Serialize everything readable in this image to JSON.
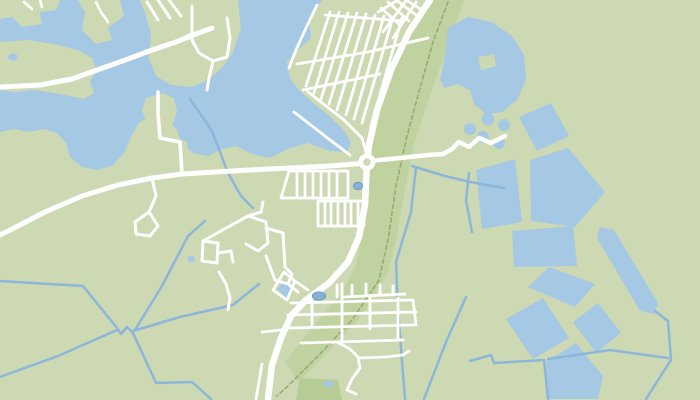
{
  "map": {
    "kind": "unlabeled-map-viewport",
    "visible_text": [],
    "colors": {
      "land": "#cdd9b2",
      "forest": "#c0d2a0",
      "forest_dark": "#b6cc95",
      "water": "#a5c8e4",
      "canal": "#8cb6da",
      "pond_dark_fill": "#8ab2d8",
      "pond_dark_stroke": "#6f9fc8",
      "road": "#ffffff",
      "trail": "#94ae72"
    },
    "layers": [
      {
        "name": "land-base",
        "kind": "polygon",
        "fill": "land",
        "d": "M0,0 L700,0 L700,400 L0,400 Z"
      },
      {
        "name": "forest-rail-strip",
        "kind": "polygon",
        "fill": "forest",
        "d": "M430,0 L464,0 L448,45 L430,95 L414,145 L404,195 L396,240 L388,272 L360,318 L322,358 L298,382 L285,362 L310,330 L340,295 L355,268 L362,235 L366,198 L369,160 L372,120 L382,83 L398,45 Z"
      },
      {
        "name": "forest-south-patch",
        "kind": "polygon",
        "fill": "forest_dark",
        "d": "M300,378 L338,380 L342,400 L296,400 Z"
      },
      {
        "name": "lake-northwest",
        "kind": "polygon",
        "fill": "water",
        "d": "M0,0 L322,0 L309,18 L311,38 L298,50 L287,62 L290,78 L299,90 L312,102 L328,115 L342,128 L351,142 L347,152 L330,151 L308,143 L287,149 L270,158 L252,154 L236,146 L222,149 L208,156 L193,153 L182,144 L177,130 L167,119 L152,115 L139,123 L131,137 L124,153 L113,165 L98,170 L82,167 L70,157 L66,143 L57,133 L44,129 L28,132 L14,129 L0,132 Z"
      },
      {
        "name": "lake-northeast",
        "kind": "polygon",
        "fill": "water",
        "d": "M448,28 L468,17 L492,22 L512,36 L524,55 L526,80 L517,100 L502,112 L486,114 L474,104 L470,90 L458,84 L444,88 L440,80 L445,55 Z"
      },
      {
        "name": "island-corner",
        "kind": "polygon",
        "fill": "land",
        "d": "M0,0 L60,0 L56,10 L40,12 L42,24 L22,27 L12,17 L0,19 Z"
      },
      {
        "name": "island-north",
        "kind": "polygon",
        "fill": "land",
        "d": "M78,0 L120,0 L124,16 L108,28 L112,40 L96,44 L82,30 L85,12 Z"
      },
      {
        "name": "peninsula",
        "kind": "polygon",
        "fill": "land",
        "d": "M140,0 L238,0 L241,28 L233,52 L222,68 L208,80 L191,87 L171,85 L156,76 L149,58 L151,34 L146,16 Z"
      },
      {
        "name": "shore-west-band",
        "kind": "polygon",
        "fill": "land",
        "d": "M0,42 L28,40 L54,44 L78,50 L92,58 L96,70 L90,82 L94,93 L84,99 L60,94 L34,90 L15,92 L0,90 Z"
      },
      {
        "name": "land-tongue",
        "kind": "polygon",
        "fill": "land",
        "d": "M146,98 L163,93 L174,98 L177,112 L171,128 L177,138 L187,142 L189,156 L181,168 L165,171 L151,168 L147,153 L151,139 L147,124 L142,110 Z"
      },
      {
        "name": "lake-island-northeast",
        "kind": "polygon",
        "fill": "land",
        "d": "M478,57 L494,54 L496,66 L481,70 Z"
      },
      {
        "name": "basin-mid-1",
        "kind": "polygon",
        "fill": "water",
        "d": "M519,117 L551,103 L569,136 L537,151 Z"
      },
      {
        "name": "basin-mid-2",
        "kind": "polygon",
        "fill": "water",
        "d": "M476,170 L515,159 L522,222 L482,229 Z"
      },
      {
        "name": "basin-mid-3",
        "kind": "polygon",
        "fill": "water",
        "d": "M530,160 L568,148 L605,192 L575,227 L531,221 Z"
      },
      {
        "name": "basin-mid-4",
        "kind": "polygon",
        "fill": "water",
        "d": "M512,231 L573,226 L577,266 L514,267 Z"
      },
      {
        "name": "lake-long-narrow",
        "kind": "polygon",
        "fill": "water",
        "d": "M600,227 L614,230 L658,303 L654,314 L640,311 L597,238 Z"
      },
      {
        "name": "basin-south-1",
        "kind": "polygon",
        "fill": "water",
        "d": "M528,287 L549,267 L595,284 L575,307 Z"
      },
      {
        "name": "basin-south-2",
        "kind": "polygon",
        "fill": "water",
        "d": "M506,319 L543,298 L569,338 L533,359 Z"
      },
      {
        "name": "basin-south-3",
        "kind": "polygon",
        "fill": "water",
        "d": "M573,322 L598,303 L621,333 L596,353 Z"
      },
      {
        "name": "basin-south-4",
        "kind": "polygon",
        "fill": "water",
        "d": "M546,362 L576,343 L603,376 L598,399 L548,399 Z"
      },
      {
        "name": "pond-cluster-1",
        "kind": "circle",
        "fill": "water",
        "cx": 470,
        "cy": 129,
        "r": 6
      },
      {
        "name": "pond-cluster-2",
        "kind": "circle",
        "fill": "water",
        "cx": 488,
        "cy": 119,
        "r": 6.5
      },
      {
        "name": "pond-cluster-3",
        "kind": "circle",
        "fill": "water",
        "cx": 504,
        "cy": 125,
        "r": 6
      },
      {
        "name": "pond-cluster-4",
        "kind": "circle",
        "fill": "water",
        "cx": 483,
        "cy": 137,
        "r": 6
      },
      {
        "name": "pond-cluster-5",
        "kind": "circle",
        "fill": "water",
        "cx": 499,
        "cy": 143,
        "r": 6
      },
      {
        "name": "pond-shore-west",
        "kind": "ellipse",
        "fill": "water",
        "cx": 13,
        "cy": 57,
        "rx": 5,
        "ry": 3.5
      },
      {
        "name": "pond-industrial",
        "kind": "ellipse",
        "fill": "water",
        "cx": 191,
        "cy": 259,
        "rx": 4,
        "ry": 3
      },
      {
        "name": "pond-village-diamond",
        "kind": "polygon",
        "fill": "water",
        "d": "M285,280 L294,288 L286,298 L277,289 Z"
      },
      {
        "name": "pond-village-tiny",
        "kind": "polygon",
        "fill": "water",
        "d": "M324,381 L334,382 L333,387 L323,386 Z"
      },
      {
        "name": "canal-lake-outlet",
        "kind": "line",
        "stroke": "canal",
        "w": 2.5,
        "d": "M190,99 L212,131 L228,173 L241,196 L253,208"
      },
      {
        "name": "canal-west-long",
        "kind": "line",
        "stroke": "canal",
        "w": 2.5,
        "d": "M0,281 L83,286 L117,328 L121,334 L127,327 L133,333"
      },
      {
        "name": "canal-southwest-1",
        "kind": "line",
        "stroke": "canal",
        "w": 2.5,
        "d": "M133,333 L156,383 L192,382 L211,399"
      },
      {
        "name": "canal-southwest-2",
        "kind": "line",
        "stroke": "canal",
        "w": 2.5,
        "d": "M0,377 L58,356 L117,330"
      },
      {
        "name": "canal-to-village",
        "kind": "line",
        "stroke": "canal",
        "w": 2.5,
        "d": "M133,331 L180,317 L233,305 L259,284"
      },
      {
        "name": "canal-industrial-link",
        "kind": "line",
        "stroke": "canal",
        "w": 2.5,
        "d": "M205,221 L188,236 L162,286 L135,330"
      },
      {
        "name": "canal-east-west",
        "kind": "line",
        "stroke": "canal",
        "w": 2.5,
        "d": "M412,166 L445,176 L470,182 L504,188"
      },
      {
        "name": "canal-east-vertical",
        "kind": "line",
        "stroke": "canal",
        "w": 2.5,
        "d": "M416,167 L411,212 L396,262 L398,310 L405,399"
      },
      {
        "name": "canal-southeast-1",
        "kind": "line",
        "stroke": "canal",
        "w": 2.5,
        "d": "M466,297 L446,342 L424,399"
      },
      {
        "name": "canal-basin-edge-1",
        "kind": "line",
        "stroke": "canal",
        "w": 2.5,
        "d": "M470,361 L491,355 L494,363 L544,360 L548,399"
      },
      {
        "name": "canal-basin-edge-2",
        "kind": "line",
        "stroke": "canal",
        "w": 2.5,
        "d": "M548,359 L610,350 L668,358"
      },
      {
        "name": "canal-basin-edge-3",
        "kind": "line",
        "stroke": "canal",
        "w": 2.5,
        "d": "M655,311 L668,321 L671,360 L646,399"
      },
      {
        "name": "canal-basin-edge-4",
        "kind": "line",
        "stroke": "canal",
        "w": 2.5,
        "d": "M469,173 L466,200 L472,232"
      },
      {
        "name": "trail-dashed",
        "kind": "line",
        "stroke": "trail",
        "w": 1.6,
        "dash": "4 3",
        "d": "M448,2 L433,42 L420,88 L407,136 L396,186 L388,240 L379,280 L352,320 L318,356 L290,384 L277,396"
      },
      {
        "name": "road-island-stubs",
        "kind": "line",
        "stroke": "road",
        "w": 2.6,
        "d": "M24,2 L32,9 M40,0 L42,7 M96,2 L101,12 L108,22"
      },
      {
        "name": "road-peninsula-streets",
        "kind": "line",
        "stroke": "road",
        "w": 3,
        "d": "M192,6 L192,40 L199,53 L213,61 L227,57 L230,38 L227,18 M176,42 L193,33 M213,61 L209,78 L207,90 M147,2 L158,20 M158,0 L170,18 M169,0 L181,16"
      },
      {
        "name": "road-bridge-west",
        "kind": "line",
        "stroke": "road",
        "w": 5,
        "d": "M0,87 L40,85 L72,79 L100,69 L128,59 L152,50 L176,42 L196,34 L212,28"
      },
      {
        "name": "road-vertical-north",
        "kind": "line",
        "stroke": "road",
        "w": 3.6,
        "d": "M158,92 L158,113 L160,138 L180,142 L182,174"
      },
      {
        "name": "road-ew-west",
        "kind": "line",
        "stroke": "road",
        "w": 5,
        "d": "M367,163 L330,166 L290,168 L250,170 L215,172 L182,174 L152,178 L118,185 L82,196 L45,212 L16,227 L0,235"
      },
      {
        "name": "road-loop-spur",
        "kind": "line",
        "stroke": "road",
        "w": 3,
        "d": "M152,178 L156,196 L149,212 M149,212 L135,222 L136,234 L150,236 L158,226 L149,212"
      },
      {
        "name": "road-ew-east",
        "kind": "line",
        "stroke": "road",
        "w": 4.5,
        "d": "M369,161 L400,158 L428,155 L443,154 L452,149 L459,142 L469,147 L479,138 L491,143 L505,136"
      },
      {
        "name": "streets-grid-north",
        "kind": "line",
        "stroke": "road",
        "w": 2.8,
        "d": "M330,12 L306,86 M339,12 L314,93 M348,13 L321,99 M357,13 L329,104 M366,14 L337,110 M375,15 L346,115 M384,16 L354,119 M393,17 L362,123 M402,18 L371,126 M325,15 L404,21 M297,64 L368,52 L428,38 M303,90 L380,74 M317,5 L306,28 L296,50 L289,68 M308,92 L344,120 L362,138 L366,152 M294,112 L330,140 L350,155"
      },
      {
        "name": "streets-grid-northeast",
        "kind": "line",
        "stroke": "road",
        "w": 2.8,
        "d": "M405,2 L383,32 M416,2 L393,38 M381,8 L401,26 M388,2 L409,21 M396,0 L416,15 M406,0 L422,10 M378,12 L398,0"
      },
      {
        "name": "streets-grid-central",
        "kind": "line",
        "stroke": "road",
        "w": 2.8,
        "d": "M289,171 L348,171 L348,198 L281,198 L289,171 M297,172 L297,197 M305,172 L305,197 M313,172 L313,197 M321,172 L321,197 M329,172 L329,197 M337,172 L337,197 M318,201 L364,201 L364,226 L318,226 L318,201 M325,202 L325,225 M331,202 L331,225 M338,202 L338,225 M345,202 L345,225 M351,202 L351,225 M358,202 L358,225"
      },
      {
        "name": "streets-industrial",
        "kind": "line",
        "stroke": "road",
        "w": 3,
        "d": "M203,241 L228,227 L248,216 L261,212 M261,212 L263,202 M248,216 L266,222 L268,243 L258,251 L246,244 M203,241 L202,261 L217,263 L218,243 L203,241 M218,253 L231,251 L233,262 M266,228 L283,233 L285,267 L292,274 L288,284 L275,280 L266,256 M288,284 L298,292 M219,272 L226,284 L230,298 L228,310"
      },
      {
        "name": "streets-village",
        "kind": "line",
        "stroke": "road",
        "w": 2.8,
        "d": "M291,303 L413,300 M288,315 L416,312 M288,328 L414,325 M301,343 L403,340 M344,297 L405,294 M352,296 L352,285 M366,295 L366,284 M380,295 L380,285 M393,294 L393,286 M337,285 L337,297 M312,301 L312,327 M342,284 L342,342 M370,295 L370,329 M398,298 L398,340 M413,300 L416,325 M337,342 L350,349 L358,357 L360,368 L352,379 L347,390 L356,394 M360,358 L385,357 L403,355 L409,351 M281,330 L262,332 M262,364 L256,399 M284,272 L295,281 L287,300 L273,290 L284,272 M295,281 L308,290"
      },
      {
        "name": "road-main-north-south",
        "kind": "line",
        "stroke": "road",
        "w": 6.5,
        "d": "M430,0 L409,32 L391,70 L377,110 L369,145 L367,163 L365,205 L359,237 L348,262 L329,283 L306,300 L291,316 L281,338 L272,365 L268,399"
      },
      {
        "name": "roundabout-ring",
        "kind": "circle",
        "fill": "road",
        "cx": 367,
        "cy": 162,
        "r": 8.5
      },
      {
        "name": "roundabout-center",
        "kind": "circle",
        "fill": "land",
        "cx": 367,
        "cy": 162,
        "r": 3.8
      },
      {
        "name": "pond-village-dark",
        "kind": "ellipse",
        "fill": "pond_dark_fill",
        "strokeColor": "pond_dark_stroke",
        "w": 1.2,
        "cx": 319,
        "cy": 296,
        "rx": 6.5,
        "ry": 4
      },
      {
        "name": "pond-grid-dark",
        "kind": "ellipse",
        "fill": "pond_dark_fill",
        "strokeColor": "pond_dark_stroke",
        "w": 1.2,
        "cx": 358,
        "cy": 186,
        "rx": 4.5,
        "ry": 3.5
      }
    ]
  }
}
